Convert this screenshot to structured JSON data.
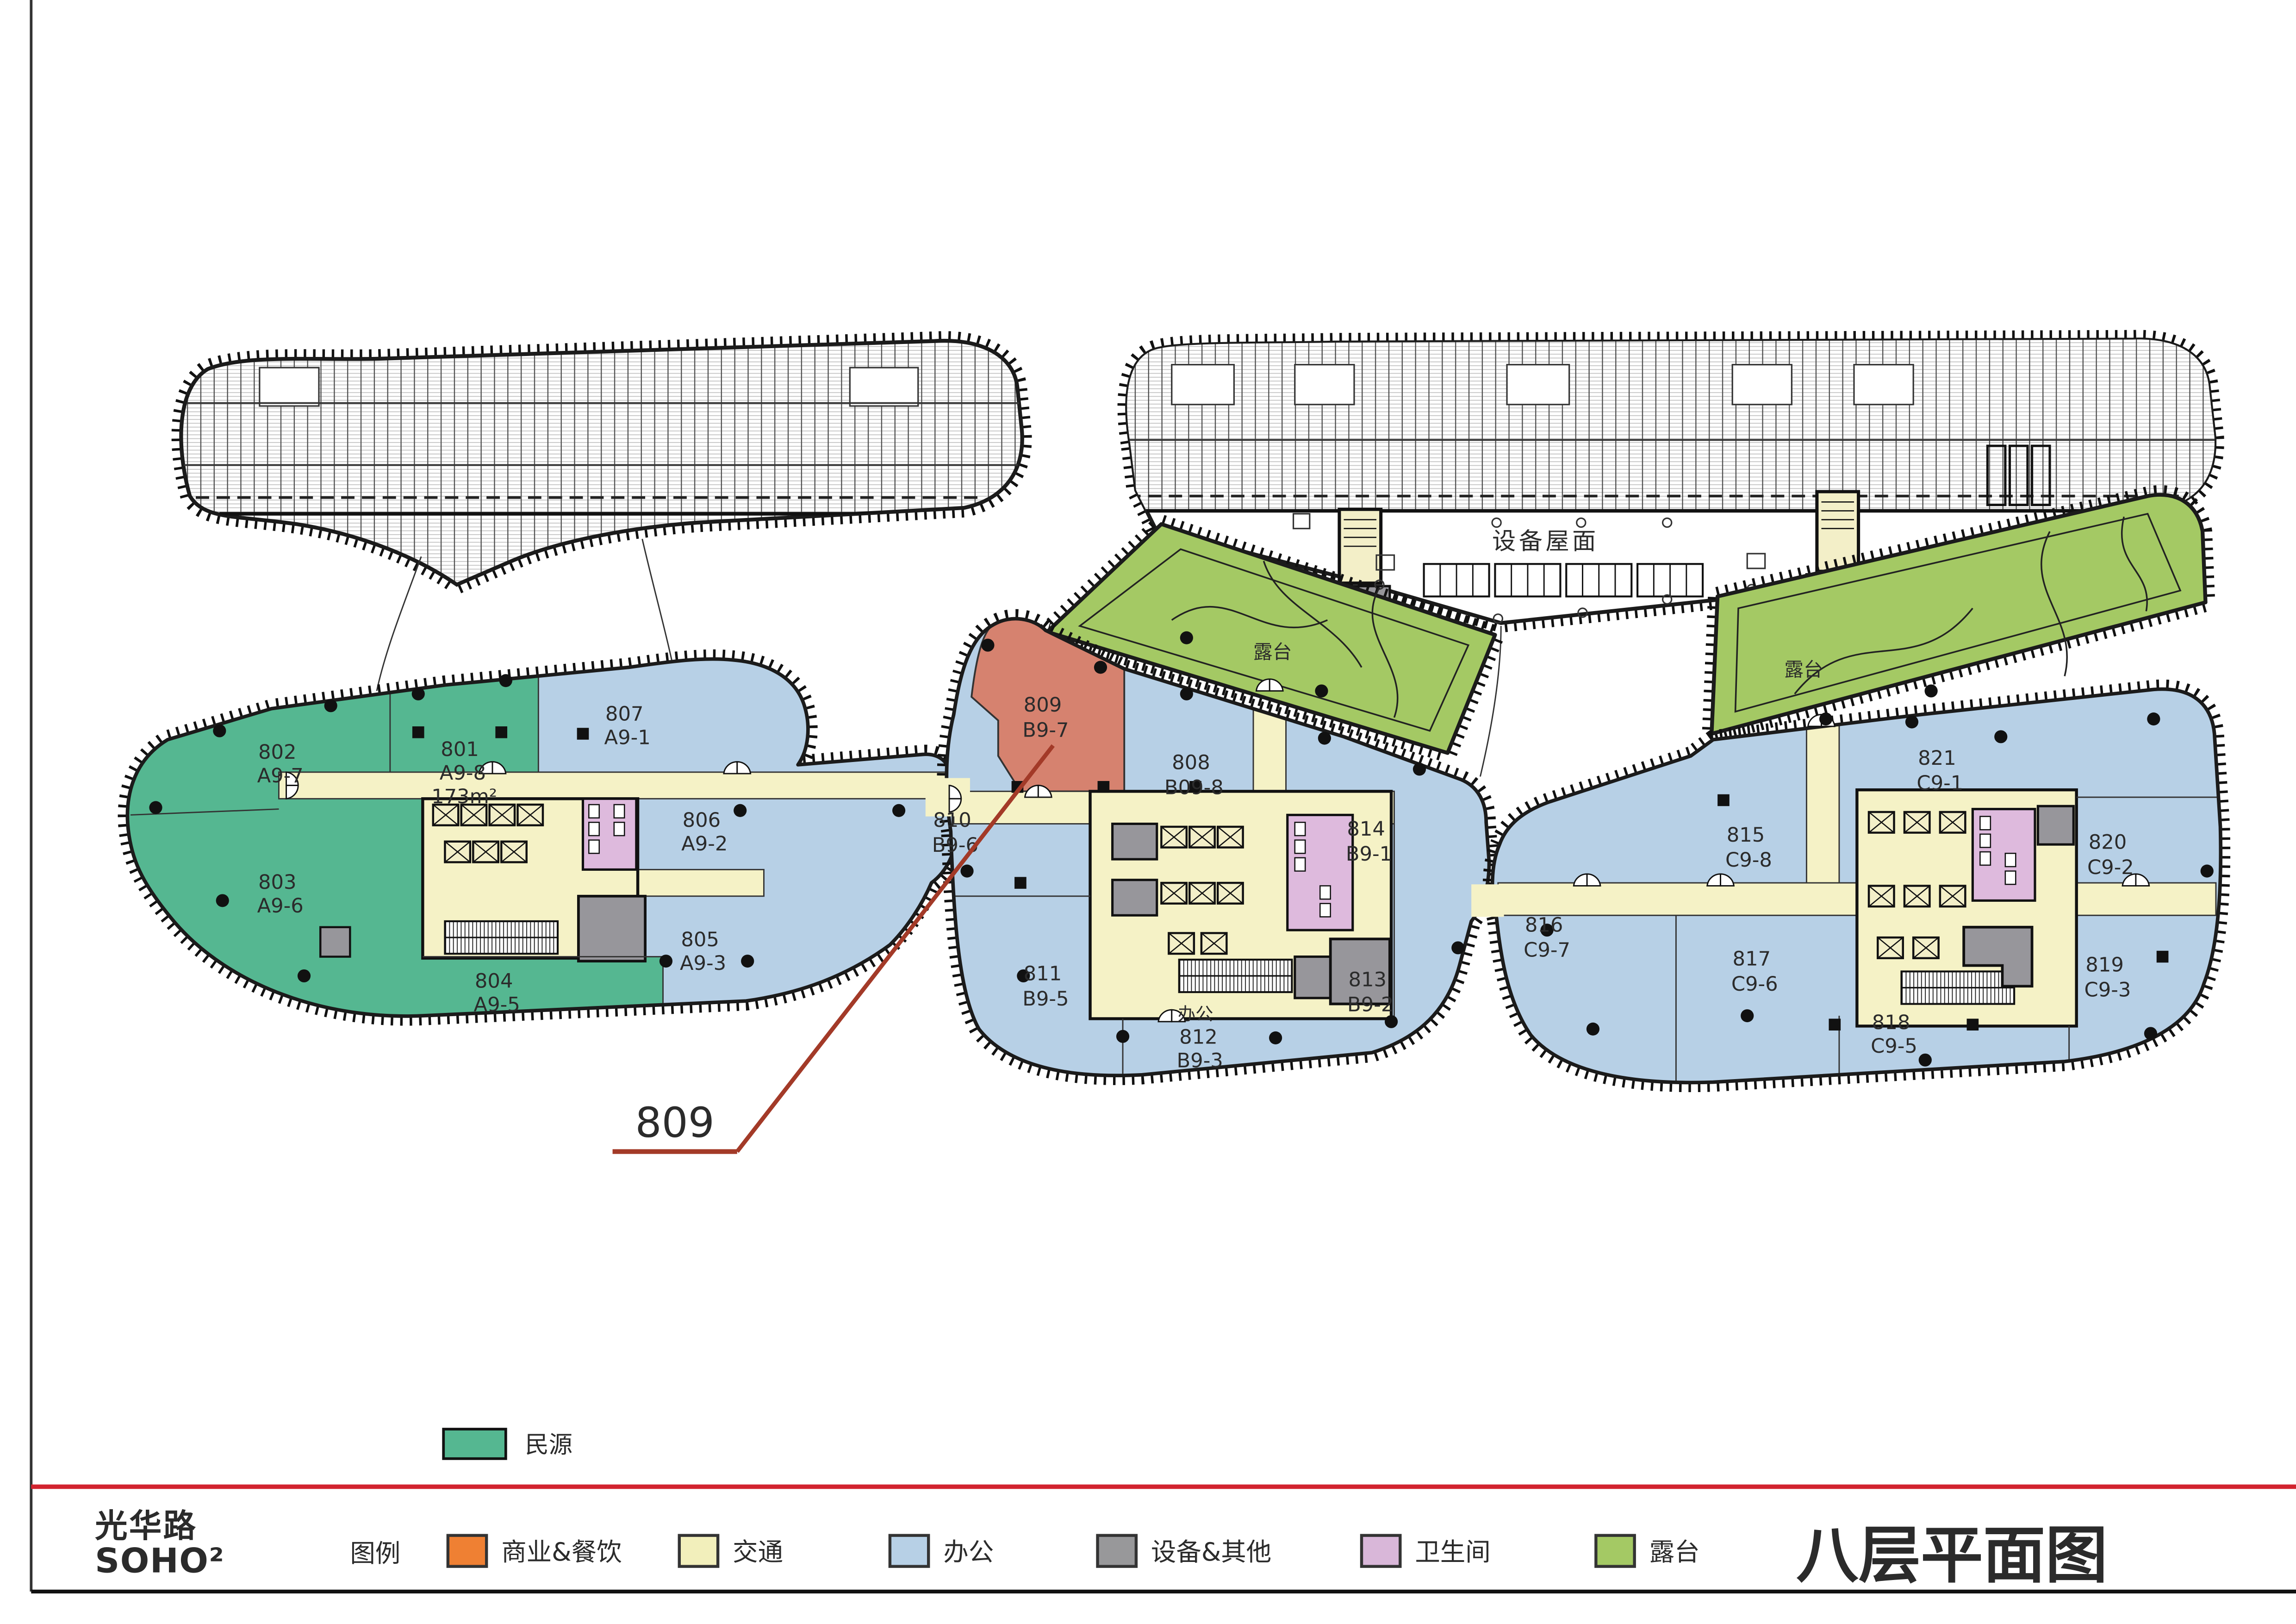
{
  "page": {
    "title": "八层平面图"
  },
  "logo": {
    "line1": "光华路",
    "line2": "SOHO²"
  },
  "top_legend": {
    "label": "民源",
    "color": "#55b791"
  },
  "legend": {
    "title": "图例",
    "items": [
      {
        "label": "商业&餐饮",
        "color": "#ef8033"
      },
      {
        "label": "交通",
        "color": "#f2efbb"
      },
      {
        "label": "办公",
        "color": "#b7d0e6"
      },
      {
        "label": "设备&其他",
        "color": "#98989a"
      },
      {
        "label": "卫生间",
        "color": "#d9b7d9"
      },
      {
        "label": "露台",
        "color": "#a4c964"
      }
    ]
  },
  "plan": {
    "equipment_roof_label": "设备屋面",
    "terrace_left_label": "露台",
    "terrace_right_label": "露台",
    "callout_label": "809",
    "rooms": [
      {
        "number": "802",
        "code": "A9-7",
        "category": "minyuan"
      },
      {
        "number": "801",
        "code": "A9-8",
        "area": "173m²",
        "category": "minyuan"
      },
      {
        "number": "803",
        "code": "A9-6",
        "category": "minyuan"
      },
      {
        "number": "804",
        "code": "A9-5",
        "category": "minyuan"
      },
      {
        "number": "807",
        "code": "A9-1",
        "category": "office"
      },
      {
        "number": "806",
        "code": "A9-2",
        "category": "office"
      },
      {
        "number": "805",
        "code": "A9-3",
        "category": "office"
      },
      {
        "number": "809",
        "code": "B9-7",
        "category": "highlighted"
      },
      {
        "number": "808",
        "code": "B09-8",
        "category": "office"
      },
      {
        "number": "810",
        "code": "B9-6",
        "category": "office"
      },
      {
        "number": "811",
        "code": "B9-5",
        "category": "office"
      },
      {
        "number": "812",
        "code": "B9-3",
        "prefix": "办公",
        "category": "office"
      },
      {
        "number": "813",
        "code": "B9-2",
        "category": "office"
      },
      {
        "number": "814",
        "code": "B9-1",
        "category": "office"
      },
      {
        "number": "815",
        "code": "C9-8",
        "category": "office"
      },
      {
        "number": "821",
        "code": "C9-1",
        "category": "office"
      },
      {
        "number": "820",
        "code": "C9-2",
        "category": "office"
      },
      {
        "number": "816",
        "code": "C9-7",
        "category": "office"
      },
      {
        "number": "817",
        "code": "C9-6",
        "category": "office"
      },
      {
        "number": "818",
        "code": "C9-5",
        "category": "office"
      },
      {
        "number": "819",
        "code": "C9-3",
        "category": "office"
      }
    ]
  },
  "colors": {
    "outline": "#1b1b1b",
    "red_rule": "#d2232e",
    "callout_red": "#a33a28",
    "hatch_line": "#c4c4c4"
  }
}
